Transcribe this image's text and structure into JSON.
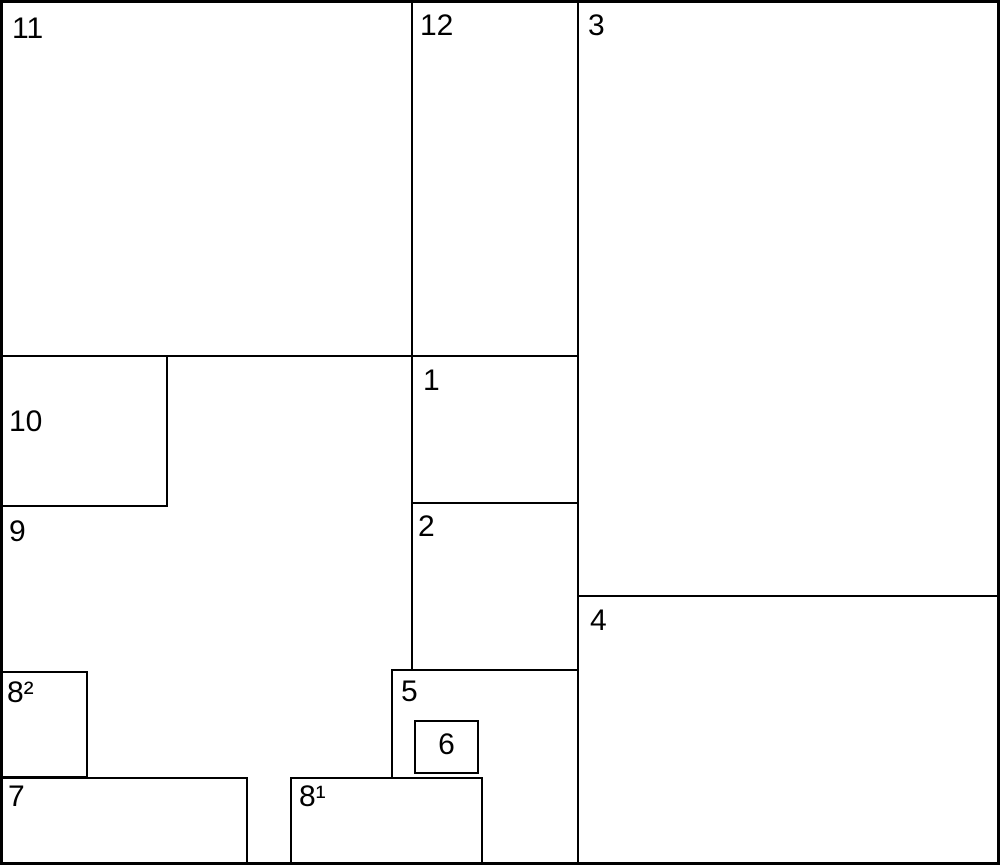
{
  "diagram": {
    "type": "rectangle-subdivision",
    "colors": {
      "background": "#ffffff",
      "line": "#000000",
      "text": "#000000"
    },
    "labels": {
      "r1": "1",
      "r2": "2",
      "r3": "3",
      "r4": "4",
      "r5": "5",
      "r6": "6",
      "r7": "7",
      "r8_first": "8¹",
      "r8_second": "8²",
      "r9": "9",
      "r10": "10",
      "r11": "11",
      "r12": "12"
    }
  }
}
